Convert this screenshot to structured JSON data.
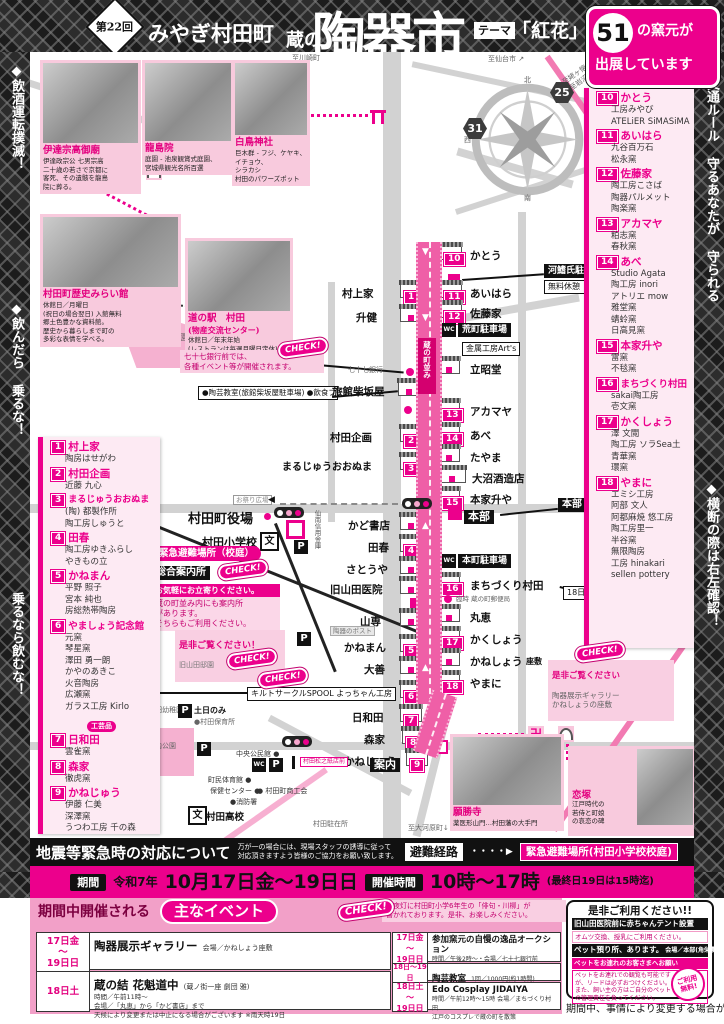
{
  "header": {
    "round": "第22回",
    "region": "みやぎ村田町",
    "title_prefix": "蔵の",
    "title": "陶器市",
    "theme_label": "テーマ",
    "theme": "「紅花」",
    "kiln_count": "51",
    "kiln_suffix": "の窯元が",
    "kiln_line2": "出展しています"
  },
  "side": {
    "left1": "◆飲酒運転撲滅！",
    "left2": "◆飲んだら 乗るな！",
    "left3": "乗るなら飲むな！",
    "right1": "◆交通ルール 守るあなたが 守られる",
    "right2": "◆横断の際は右左確認！"
  },
  "icons": {
    "p": "P",
    "wc": "WC",
    "bun": "文",
    "manji": "卍",
    "down": "▼",
    "up": "▲",
    "left": "◀",
    "check": "CHECK!",
    "arrow": "・・・・▶"
  },
  "compass": {
    "n": "北",
    "s": "南",
    "e": "東",
    "w": "西"
  },
  "landmarks": {
    "date_mausoleum": {
      "name": "伊達宗高御廟",
      "desc": "伊達政宗公 七男宗高\n二十歳の若さで京都に\n客死、その遺骸を龍島\n院に葬る。"
    },
    "ryuto": {
      "name": "龍島院",
      "desc": "庭園 - 池泉観賞式庭園、\n宮城県観光名所百選"
    },
    "shiratori": {
      "name": "白鳥神社",
      "desc": "巨木群 - フジ、ケヤキ、\nイチョウ、\nシラカシ\n村田のパワーズポット"
    },
    "mirai": {
      "name": "村田町歴史みらい館",
      "desc": "休館日／月曜日\n(祝日の場合翌日) 入館無料\n郷土色豊かな資料館。\n歴史から暮らしまで町の\n多彩な表情を学べる。"
    },
    "michinoeki": {
      "name": "道の駅　村田",
      "sub": "(物産交流センター)",
      "desc": "休館日／年末年始\n(レストランは毎週月曜日定休)\n地元の新鮮野菜や農産物、\n特産品等 お土産に最適な施設。"
    },
    "gansho": {
      "name": "願勝寺",
      "desc": "薬医形山門…村田藩の大手門"
    },
    "koizuka": {
      "name": "恋塚",
      "desc": "江戸時代の\n若侍と町娘\nの哀恋の碑"
    }
  },
  "vendors_left": [
    {
      "num": "1",
      "name": "村上家",
      "members": "陶房はせがわ"
    },
    {
      "num": "2",
      "name": "村田企画",
      "members": "近藤 九心"
    },
    {
      "num": "3",
      "name": "まるじゅうおおぬま",
      "members": "(陶) 都製作所\n陶工房しゅうと"
    },
    {
      "num": "4",
      "name": "田春",
      "members": "陶工房ゆきふらし\nやきもの立"
    },
    {
      "num": "5",
      "name": "かねまん",
      "members": "平野 照子\n宮本 純也\n房総熱帯陶房"
    },
    {
      "num": "6",
      "name": "やましょう記念館",
      "members": "元窯\n琴星窯\n澤田 勇一朗\nかやのあきこ\n火音陶房\n広瀬窯\nガラス工房 Kirlo"
    },
    {
      "num": "7",
      "name": "日和田",
      "members": "雲雀窯"
    },
    {
      "num": "8",
      "name": "森家",
      "members": "徹虎窯"
    },
    {
      "num": "9",
      "name": "かねじゅう",
      "members": "伊藤 仁美\n深澤窯\nうつわ工房 千の森"
    }
  ],
  "craft_badge": "工芸品",
  "vendors_right": [
    {
      "num": "10",
      "name": "かとう",
      "members": "工房みやび\nATELiER SiMASiMA"
    },
    {
      "num": "11",
      "name": "あいはら",
      "members": "九谷百万石\n松永窯"
    },
    {
      "num": "12",
      "name": "佐藤家",
      "members": "陶工房こさば\n陶器パルメット\n陶楽窯"
    },
    {
      "num": "13",
      "name": "アカマヤ",
      "members": "粕志窯\n春秋窯"
    },
    {
      "num": "14",
      "name": "あべ",
      "members": "Studio Agata\n陶工房 inori\nアトリエ mow\n雅堂窯\n蜻蛉窯\n日高見窯"
    },
    {
      "num": "15",
      "name": "本家升や",
      "members": "雷窯\n不毯窯"
    },
    {
      "num": "16",
      "name": "まちづくり村田",
      "members": "sakai陶工房\n壱文窯"
    },
    {
      "num": "17",
      "name": "かくしょう",
      "members": "澤 文閲\n陶工房 ソラSea土\n青華窯\n環窯"
    },
    {
      "num": "18",
      "name": "やまに",
      "members": "エミシ工房\n阿部 文人\n阿都麻焼 悠工房\n陶工房里一\n半谷窯\n無限陶房\n工房 hinakari\nsellen pottery"
    }
  ],
  "map": {
    "to_kawasaki": "至川崎町",
    "to_sendai": "至仙台市 ↗",
    "to_ubagafutokoro": "至姥ヶ懐・民話の里\n(至岩沼市)→",
    "route25": "25",
    "route31": "31",
    "mirai_gate": "みらいの\nゲート",
    "rekishi_gate": "歴史のゲート",
    "shiroyama_park": "城山公園",
    "street_name": "蔵の町並み",
    "murakamiya": "村上家",
    "masuken": "升健",
    "kikaku": "村田企画",
    "maruju": "まるじゅうおおぬま",
    "kado": "かど書店",
    "taharu": "田春",
    "satoya": "さとうや",
    "yamada": "旧山田医院",
    "yamasen": "山専",
    "toki_post": "陶器のポスト",
    "kaneman": "かねまん",
    "daizen": "大善",
    "yamasho": "やましょう記念館",
    "hiwada": "日和田",
    "morike": "森家",
    "kaneju": "かねじゅう",
    "annai": "案内",
    "kato": "かとう",
    "aihara": "あいはら",
    "satoke": "佐藤家",
    "rissho": "立昭堂",
    "akamaya": "アカマヤ",
    "abe": "あべ",
    "tayama": "たやま",
    "onuma": "大沼酒造店",
    "honke": "本家升や",
    "honbu": "本部",
    "machidukuri": "まちづくり村田",
    "rinji": "臨時 蔵の町郵便局",
    "marue": "丸恵",
    "kakusho": "かくしょう",
    "kanesho": "かねしょう",
    "zashiki": "座敷",
    "yamani": "やまに",
    "kawabata": "河鰭氏駐車場",
    "free_rest": "無料休憩",
    "aramachi": "荒町駐車場",
    "kinzoku": "金属工房Art's",
    "bank": "七十七銀行",
    "ryokan": "旅館柴坂屋",
    "honbu_pet": "本部\nペット預り所",
    "honmachi": "本町駐車場",
    "edo_note": "18日〜19日\nEdo Cosplay JIDAIYA\n会場/まちづくり村田",
    "check_771": "七十七銀行前では、\n各種イベント等が開催されます。",
    "booth": "●陶芸教室(旅館柴坂屋駐車場)\n●飲食ブース",
    "yakuba": "村田町役場",
    "shogakko": "村田小学校",
    "matsuri": "お祭り広場",
    "sennan": "仙南信用金庫",
    "hinan_kotei": "緊急避難場所（校庭）",
    "sogo": "総合案内所",
    "annai_head": "お気軽にお立寄りください。",
    "annai_body": "蔵の町並み内にも案内所\nがあります。\nそちらもご利用ください。",
    "zehi": "是非ご覧ください！",
    "teien": "旧山田邸園",
    "zehi2_head": "是非ご覧ください",
    "zehi2_body": "陶器展示ギャラリー\nかねしょうの座敷",
    "akachan": "赤ちゃん\nテント",
    "quilt": "キルトサークルSPOOL\nよっちゃん工房",
    "donichi": "土日のみ",
    "hoikusho": "●村田保育所",
    "yochien": "●村田幼稚園",
    "jonai": "城内公園",
    "chuo": "中央公民館 ●",
    "taiiku": "町民体育館 ●",
    "hoken": "保健センター ●",
    "shokokai": "● 村田町商工会",
    "shobo": "●消防署",
    "koko": "村田高校",
    "chuzai": "村田駐在所",
    "okawara": "至大河原町↓",
    "matsu_sign": "村田松之紙店前"
  },
  "emergency": {
    "title": "地震等緊急時の対応について",
    "body": "万が一の場合には、現場スタッフの誘導に従って\n対応頂きますよう皆様のご協力をお願い致します。",
    "route_label": "避難経路",
    "place": "緊急避難場所(村田小学校校庭)"
  },
  "period": {
    "label": "期間",
    "era": "令和7年",
    "dates": "10月17日金〜19日日",
    "time_label": "開催時間",
    "time": "10時〜17時",
    "time_note": "(最終日19日は15時迄)"
  },
  "events": {
    "heading": "期間中開催される",
    "heading_badge": "主なイベント",
    "check_note": "常夜灯に村田町小学6年生の「俳句・川柳」が\n書かれております。是非、お楽しみください。",
    "rows": [
      {
        "date": "17日金\n〜\n19日日",
        "title": "陶器展示ギャラリー",
        "detail": "会場／かねしょう座敷"
      },
      {
        "date": "18日土",
        "title": "蔵の結 花魁道中",
        "title_sub": "(蔵ノ街一座 劇団 雅)",
        "detail": "時間／午前11時〜\n会場／「丸恵」から「かど書店」まで\n天候により変更または中止になる場合がございます ※雨天時19日"
      },
      {
        "date": "17日金\n〜\n19日日",
        "title": "参加窯元の自慢の逸品オークション",
        "detail": "時間／午後2時〜・会場／七十七銀行前"
      },
      {
        "date": "18日〜19日",
        "title": "陶芸教室",
        "detail": "1回／1000円(約1時間)"
      },
      {
        "date": "18日土\n〜\n19日日",
        "title": "Edo Cosplay JIDAIYA",
        "detail": "時間／午前12時〜15時 会場／まちづくり村田\n江戸のコスプレで蔵の町を散策"
      }
    ]
  },
  "service": {
    "title": "是非ご利用ください!!",
    "baby_head": "旧山田医院前に赤ちゃんテント設置",
    "baby_body": "オムツ交換、授乳にご利用ください。",
    "pet_head": "ペット預り所、あります。",
    "pet_place": "会場／本部(角栄農機)",
    "pet_sub": "ペットをお連れのお客さまへお願い",
    "pet_body": "ペットをお連れでの観覧も可能ですが、リードは必ずおつけください。また、飼い主の方はご自分のペットの管理責任を負ってください。",
    "stamp": "ご利用\n無料!",
    "note": "期間中、事情により変更する場合があります。"
  }
}
